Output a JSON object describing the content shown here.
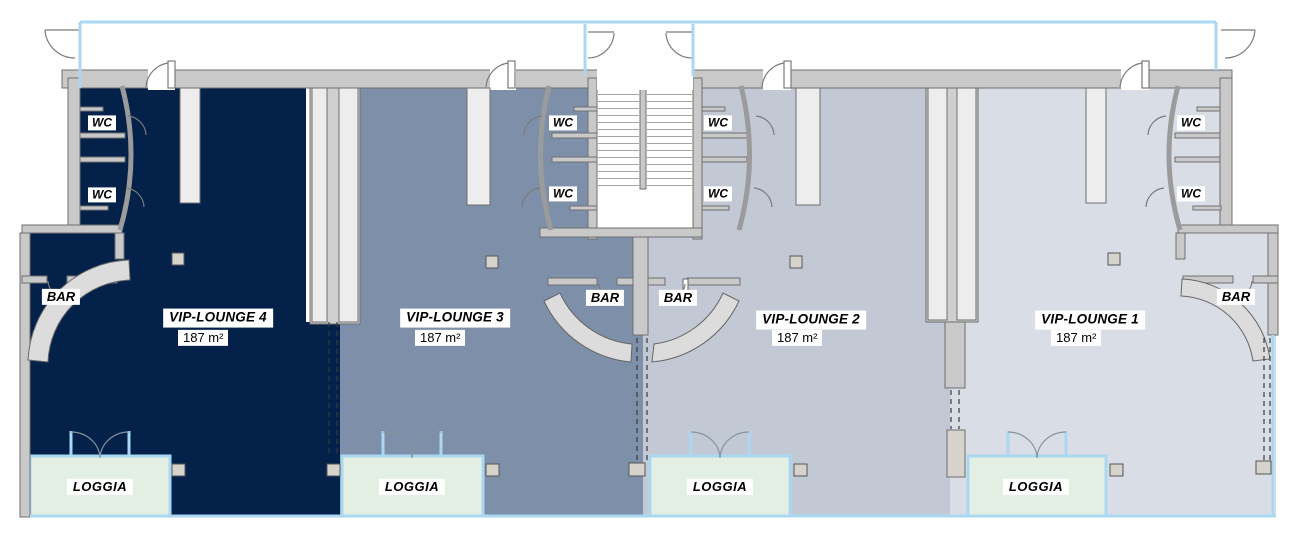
{
  "plan": {
    "labels": {
      "wc": "WC",
      "bar": "BAR",
      "loggia": "LOGGIA"
    },
    "lounges": [
      {
        "id": "vip-lounge-4",
        "name": "VIP-LOUNGE 4",
        "area": "187 m²",
        "color": "#032149"
      },
      {
        "id": "vip-lounge-3",
        "name": "VIP-LOUNGE 3",
        "area": "187 m²",
        "color": "#7e90a9"
      },
      {
        "id": "vip-lounge-2",
        "name": "VIP-LOUNGE 2",
        "area": "187 m²",
        "color": "#c2c9d5"
      },
      {
        "id": "vip-lounge-1",
        "name": "VIP-LOUNGE 1",
        "area": "187 m²",
        "color": "#d9dee6"
      }
    ],
    "colors": {
      "loggia_fill": "#e4efe3",
      "window_blue": "#aad8f2",
      "wall_fill": "#c9c9c9",
      "wall_stroke": "#6f6f6f",
      "pillar_fill": "#ededed",
      "counter_fill": "#dcdcdc",
      "column_fill": "#d6d2cc"
    }
  }
}
